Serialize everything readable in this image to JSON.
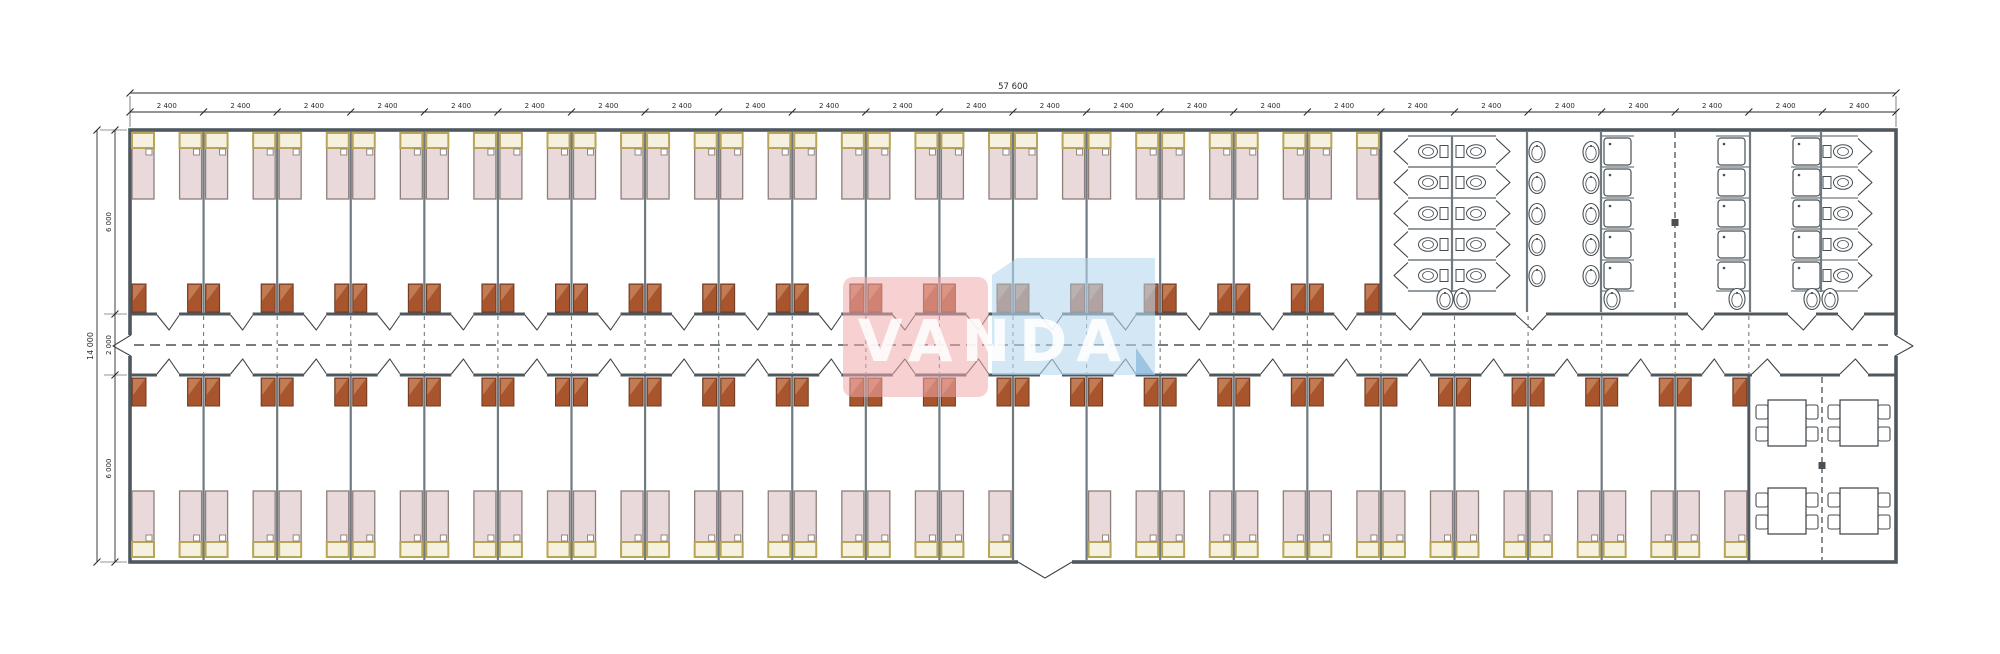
{
  "watermark": {
    "text": "VANDA",
    "red_color": "#f0a9ad",
    "blue_color": "#b5d7ee",
    "blue_fold_color": "#7fb0d4",
    "text_color": "#ffffff"
  },
  "dimensions": {
    "overall_width_label": "57 600",
    "module_width_label": "2 400",
    "module_count": 24,
    "overall_height_label": "14 000",
    "height_top_label": "6 000",
    "height_corridor_label": "2 000",
    "height_bottom_label": "6 000"
  },
  "plan": {
    "rooms_top": 17,
    "rooms_bottom": 22,
    "beds_per_room": 2,
    "vestibule_room_index": 12,
    "sanitary": {
      "wc_back_to_back_rows": 5,
      "wc_right_column_count": 5,
      "basin_column_counts": [
        5,
        5
      ],
      "shower_columns": 3,
      "showers_per_column": 5,
      "bottom_sinks": 6
    },
    "dining": {
      "tables": 4,
      "chairs_per_table": 4
    },
    "colors": {
      "bed_fill": "#ead9da",
      "bed_head_fill": "#f6f1df",
      "bed_head_frame": "#b9a558",
      "bed_outline": "#8c7f78",
      "wardrobe_fill": "#a8552e",
      "wardrobe_light": "#c17b55",
      "wardrobe_outline": "#6d3a22",
      "wall_outer": "#4f585e",
      "wall_inner": "#707a80",
      "door_line": "#3d4549",
      "fixture_line": "#474f54",
      "dash_line": "#4a5054",
      "dim_line": "#2a2a2a",
      "background": "#ffffff"
    }
  }
}
